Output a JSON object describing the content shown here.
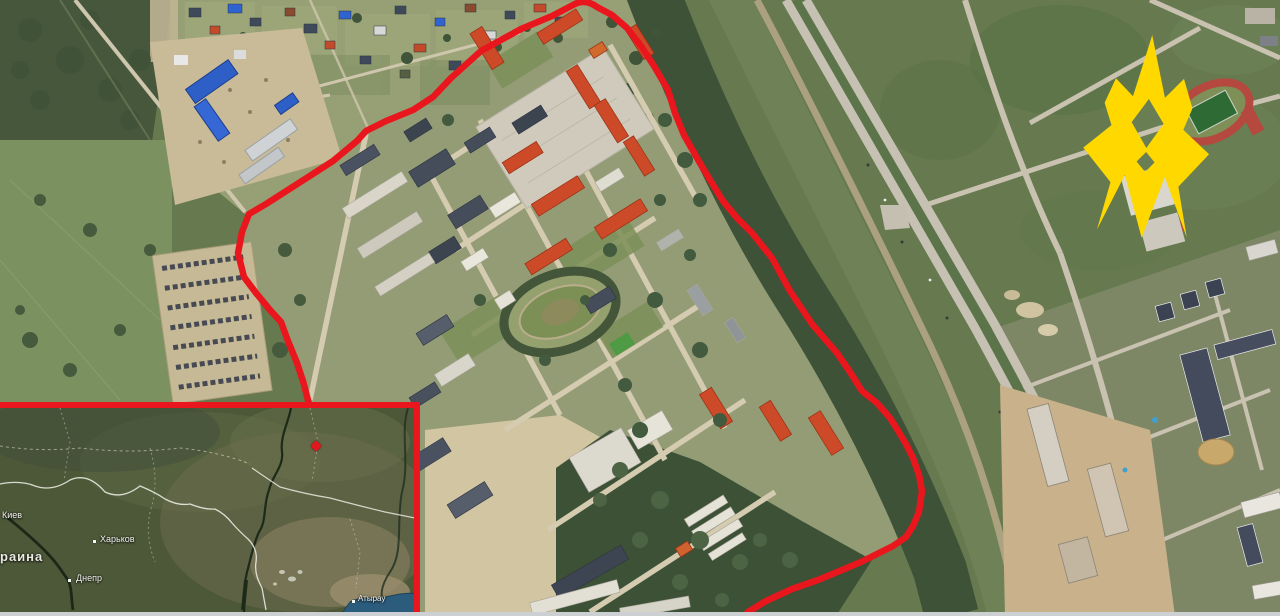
{
  "scene": {
    "description": "Satellite view of a military base outlined in red, with locator inset map and yellow emblem"
  },
  "colors": {
    "annotation_red": "#e9161d",
    "logo_yellow": "#ffd800",
    "marker_red": "#e3171e"
  },
  "boundary": {
    "name": "military-base-perimeter",
    "path": "M309,404 L303,381 297,363 288,341 281,322 270,310 256,293 244,277 238,253 242,232 249,214 266,204 291,188 333,161 357,141 366,131 386,121 413,110 433,97 451,78 481,51 521,29 552,16 573,5 Q585,-2 597,7 L612,15 627,28 641,46 654,66 668,90 675,113 684,135 697,158 710,180 723,201 737,218 752,233 772,258 790,291 812,324 824,338 837,353 850,372 862,391 877,403 890,418 897,429 906,444 913,458 919,475 922,491 919,512 913,526 906,537 893,546 879,553 861,562 842,570 818,580 792,589 766,601 748,612 742,620",
    "stroke_width": "6.5"
  },
  "logo": {
    "name": "atesh-movement-emblem",
    "path": "M70,0 L86,62 104,42 114,71 106,93 133,116 104,150 115,200 90,141 70,203 50,141 25,197 36,149 7,116 34,92 26,70 36,45 54,62 Z M70,64 L86,88 70,113 54,88 Z M70,117 L79,127 70,137 61,127 Z"
  },
  "inset_map": {
    "labels": [
      {
        "text": "Киев"
      },
      {
        "text": "Харьков"
      },
      {
        "text": "Днепр"
      },
      {
        "text": "раина"
      },
      {
        "text": "Атырау"
      }
    ]
  }
}
